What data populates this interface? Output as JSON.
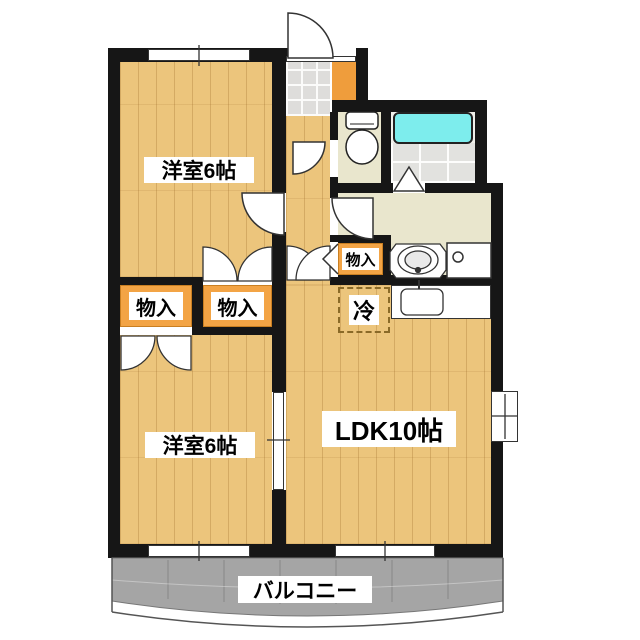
{
  "plan_type": "apartment-floor-plan",
  "rooms": {
    "western_top": {
      "label": "洋室6帖"
    },
    "western_bottom": {
      "label": "洋室6帖"
    },
    "ldk": {
      "label": "LDK10帖"
    },
    "balcony": {
      "label": "バルコニー"
    }
  },
  "storage": {
    "closet_left": {
      "label": "物入"
    },
    "closet_right": {
      "label": "物入"
    },
    "closet_hall": {
      "label": "物入"
    },
    "refrigerator": {
      "label": "冷"
    }
  },
  "fixtures": {
    "toilet": "toilet",
    "bathtub": "bathtub",
    "washbasin": "washbasin",
    "washing_machine_pan": "washing-machine-pan",
    "kitchen_sink": "kitchen-sink",
    "entrance_door": "entrance-door",
    "sliding_door": "sliding-door"
  },
  "colors": {
    "wood_floor": "#ecc57c",
    "sanitary_floor": "#e9e6cd",
    "closet_orange": "#f3a445",
    "bathtub_cyan": "#7deded",
    "balcony_gray": "#a5a5a5",
    "wall_black": "#161616"
  }
}
